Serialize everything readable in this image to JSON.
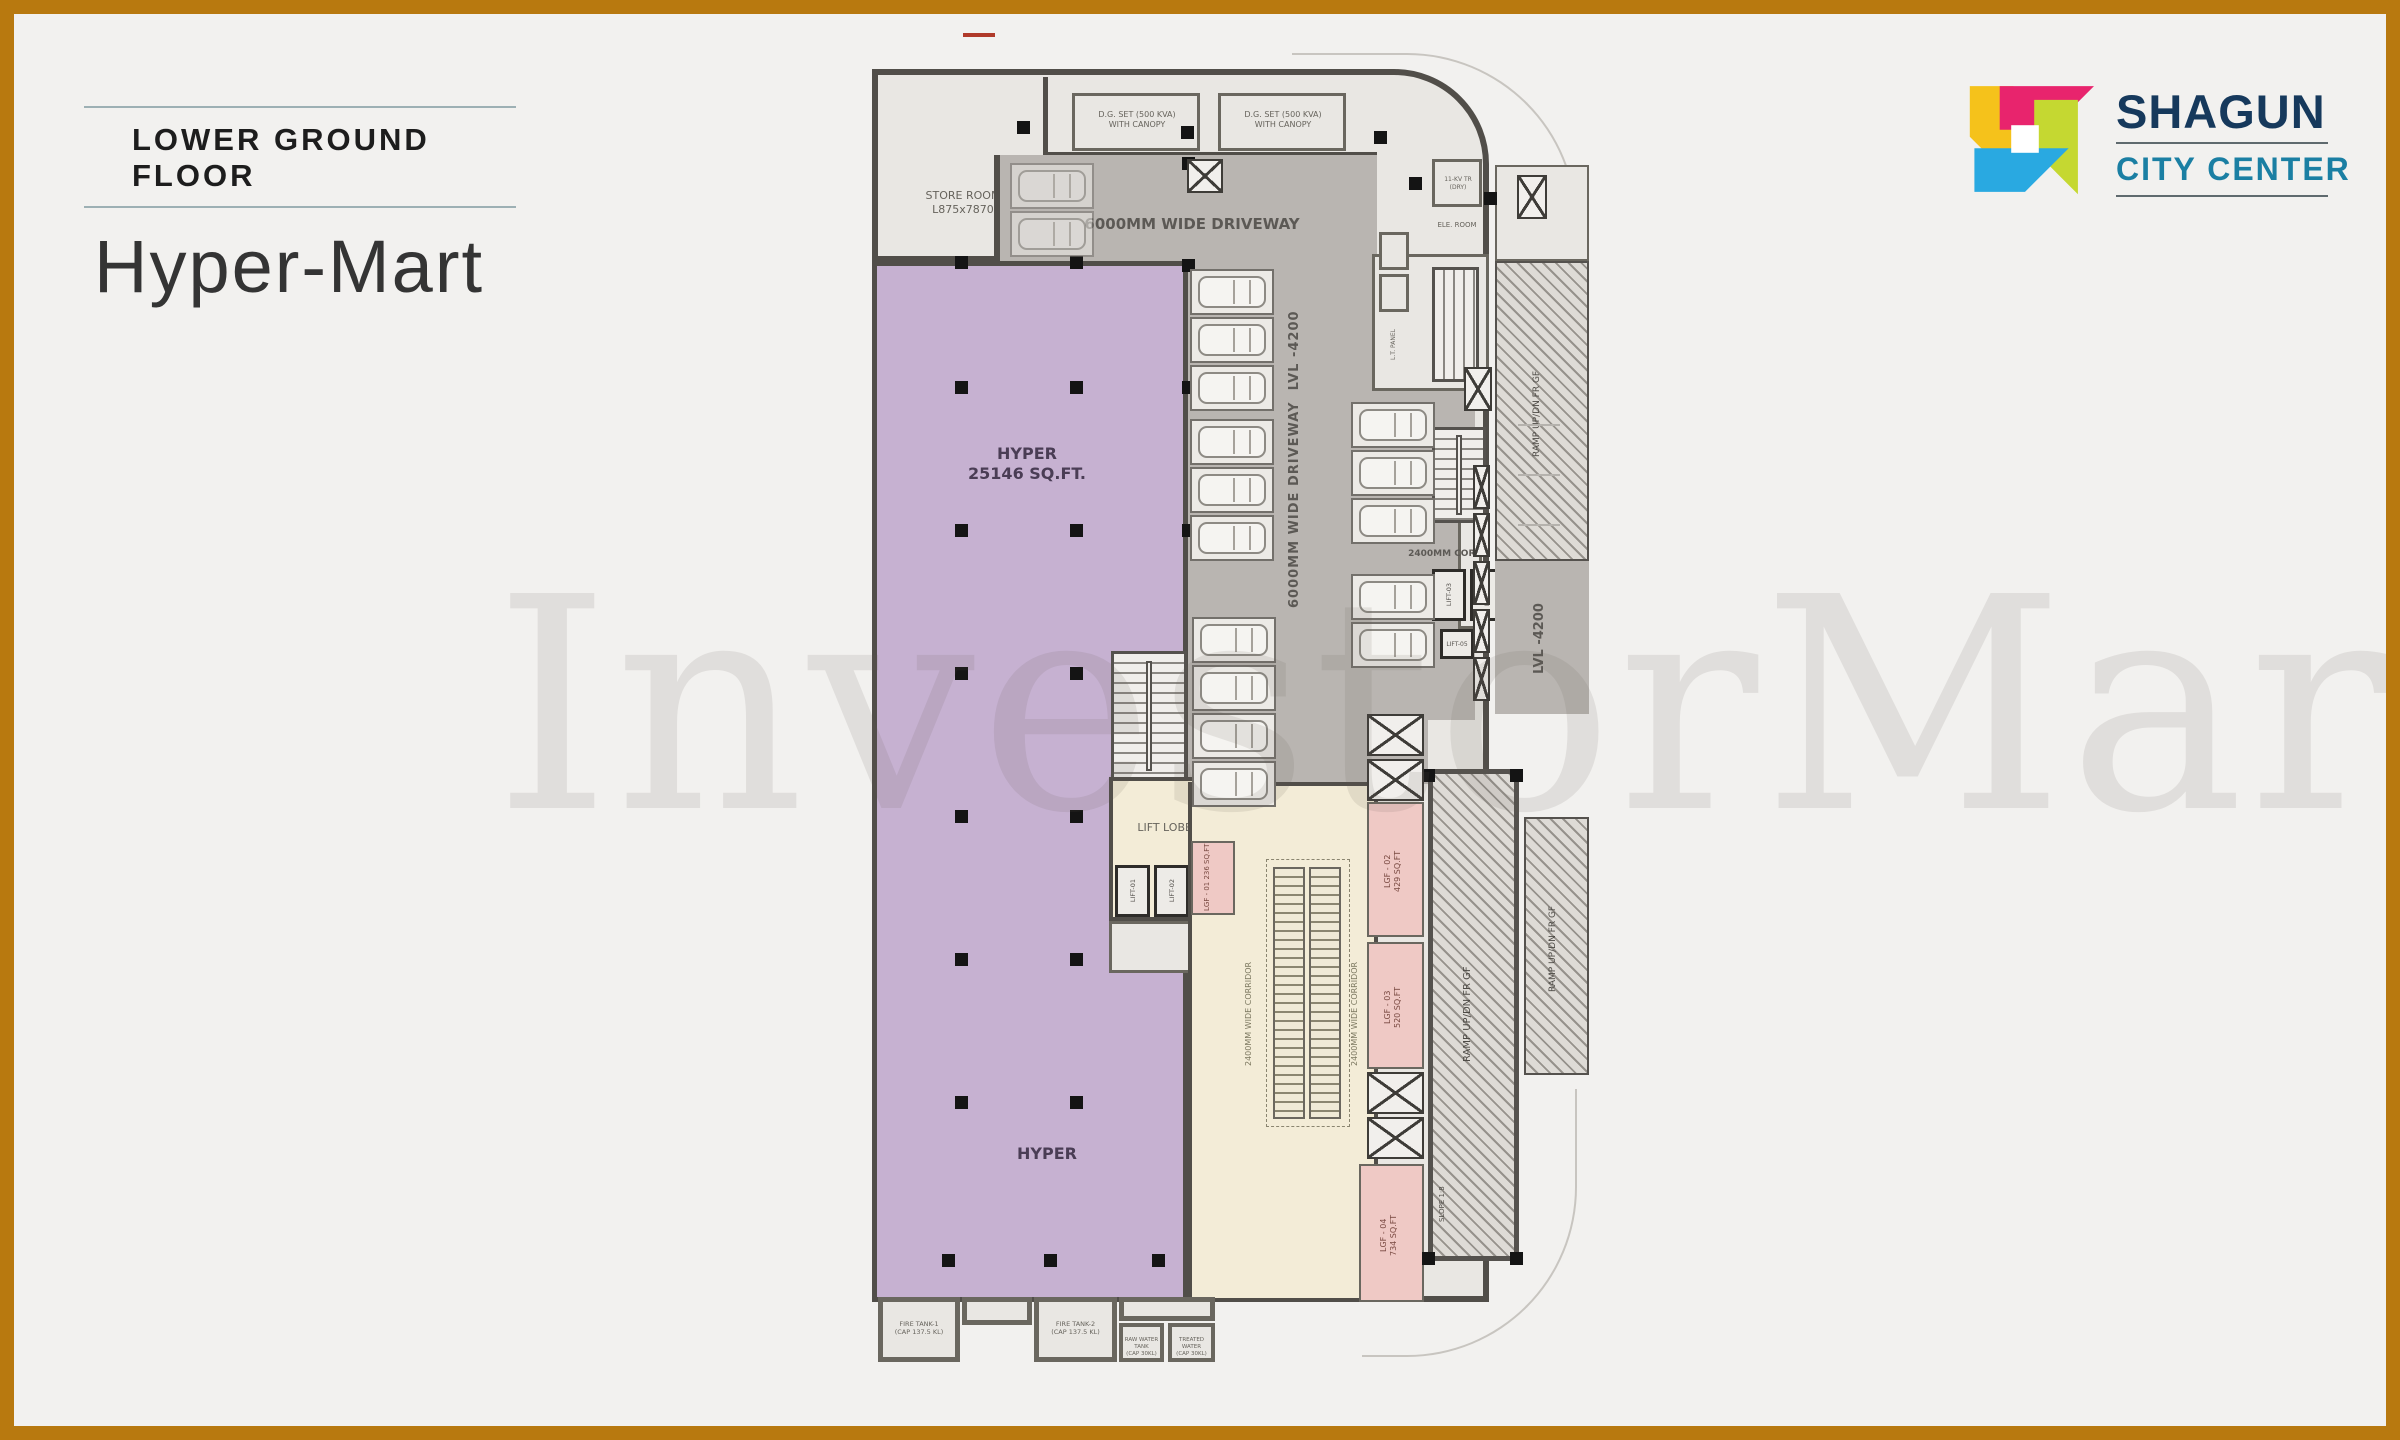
{
  "header": {
    "floor_label": "LOWER GROUND FLOOR",
    "project_name": "Hyper-Mart"
  },
  "brand": {
    "line1": "SHAGUN",
    "line2": "CITY CENTER",
    "colors": {
      "navy": "#16395c",
      "teal": "#1b7fa3",
      "yellow": "#f5c21b",
      "pink": "#e8246d",
      "green": "#c5d831",
      "blue": "#29a9e1"
    }
  },
  "watermark": {
    "text": "InvestorMart"
  },
  "plan": {
    "labels": {
      "store_room_1": "STORE ROOM",
      "store_room_2": "L875x7870",
      "dg_set_1": "D.G. SET (500 KVA)",
      "dg_set_2": "WITH CANOPY",
      "driveway_top": "6000MM WIDE DRIVEWAY",
      "driveway_side_1": "6000MM WIDE DRIVEWAY",
      "driveway_side_2": "LVL -4200",
      "hyper_name": "HYPER",
      "hyper_area": "25146 SQ.FT.",
      "hyper_lower": "HYPER",
      "lift_lobby": "LIFT LOBBY",
      "corr_2400": "2400MM CORR.",
      "corridor_wide": "2400MM WIDE CORRIDOR",
      "lvl_4200": "LVL -4200",
      "ramp_updn": "RAMP UP/DN FR GF",
      "slope": "SLOPE 1:8",
      "ele_room": "ELE. ROOM",
      "tr_1": "11-KV TR",
      "tr_2": "(DRY)",
      "lt_panel": "L.T. PANEL"
    },
    "units": [
      {
        "id": "LGF - 01",
        "area": "236 SQ.FT"
      },
      {
        "id": "LGF - 02",
        "area": "429 SQ.FT"
      },
      {
        "id": "LGF - 03",
        "area": "520 SQ.FT"
      },
      {
        "id": "LGF - 04",
        "area": "734 SQ.FT"
      }
    ],
    "lifts": [
      "LIFT-01",
      "LIFT-02",
      "LIFT-03",
      "LIFT-04",
      "LIFT-05"
    ],
    "tanks": {
      "fire1_1": "FIRE TANK-1",
      "fire1_2": "(CAP 137.5 KL)",
      "fire2_1": "FIRE TANK-2",
      "fire2_2": "(CAP 137.5 KL)",
      "raw_1": "RAW WATER TANK",
      "raw_2": "(CAP 30KL)",
      "treated_1": "TREATED WATER",
      "treated_2": "(CAP 30KL)"
    },
    "columns": [
      [
        83,
        187
      ],
      [
        198,
        187
      ],
      [
        83,
        312
      ],
      [
        198,
        312
      ],
      [
        83,
        455
      ],
      [
        198,
        455
      ],
      [
        83,
        598
      ],
      [
        198,
        598
      ],
      [
        83,
        741
      ],
      [
        198,
        741
      ],
      [
        83,
        884
      ],
      [
        198,
        884
      ],
      [
        83,
        1027
      ],
      [
        198,
        1027
      ],
      [
        70,
        1185
      ],
      [
        172,
        1185
      ],
      [
        280,
        1185
      ],
      [
        310,
        312
      ],
      [
        310,
        455
      ],
      [
        145,
        52
      ],
      [
        309,
        57
      ],
      [
        502,
        62
      ],
      [
        537,
        108
      ],
      [
        612,
        123
      ],
      [
        550,
        700
      ],
      [
        638,
        700
      ],
      [
        550,
        1183
      ],
      [
        638,
        1183
      ],
      [
        310,
        88
      ],
      [
        310,
        190
      ]
    ],
    "parking_groups": [
      {
        "x": 318,
        "y": 200,
        "count": 3
      },
      {
        "x": 318,
        "y": 350,
        "count": 3
      },
      {
        "x": 320,
        "y": 548,
        "count": 4
      },
      {
        "x": 479,
        "y": 333,
        "count": 3
      },
      {
        "x": 479,
        "y": 505,
        "count": 2
      },
      {
        "x": 138,
        "y": 94,
        "count": 2,
        "faint": true
      }
    ],
    "shaft_groups": [
      {
        "x": 601,
        "y": 396,
        "w": 17,
        "h": 44,
        "count": 5,
        "dy": 48
      },
      {
        "x": 495,
        "y": 645,
        "w": 57,
        "h": 42,
        "count": 2,
        "dy": 45
      },
      {
        "x": 495,
        "y": 1003,
        "w": 57,
        "h": 42,
        "count": 2,
        "dy": 45
      },
      {
        "x": 645,
        "y": 106,
        "w": 30,
        "h": 44,
        "count": 1,
        "dy": 0
      },
      {
        "x": 315,
        "y": 90,
        "w": 36,
        "h": 34,
        "count": 1,
        "dy": 0
      },
      {
        "x": 592,
        "y": 298,
        "w": 28,
        "h": 44,
        "count": 1,
        "dy": 0
      }
    ]
  }
}
